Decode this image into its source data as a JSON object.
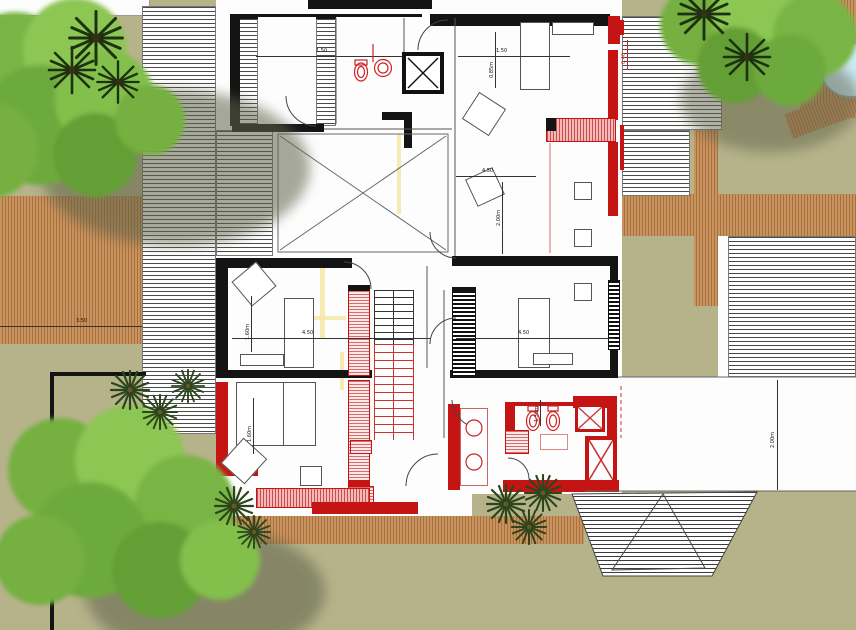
{
  "plan": {
    "type": "architectural-floor-plan-upper-level",
    "colors": {
      "lawn": "#b6b38a",
      "wood_deck": "#c9935f",
      "wood_stripe": "#a9713d",
      "roof_hatch_line": "#4a4a4a",
      "wall_black": "#141414",
      "wall_red": "#c41414",
      "pink_hatch": "#d96a6a",
      "pool_water": "#cdeaf6",
      "tree_green": "#7ab648",
      "palm_green": "#2c451c",
      "underlay_yellow": "#f4e8a6",
      "dimension_line": "#333333"
    },
    "symbols": {
      "tree": "canopy-blob",
      "palm": "frond-burst",
      "pool": "water-ellipse",
      "void_room": "x-cross-square",
      "elevator": "x-box-red",
      "shower": "x-box-red-small",
      "shaft": "x-box-black",
      "stairs_existing": "black-tread-lines",
      "stairs_new": "red-tread-lines"
    },
    "dimensions": [
      {
        "id": "deck-left-width",
        "label": "3.50"
      },
      {
        "id": "room-a-width",
        "label": "4.50"
      },
      {
        "id": "room-mid-right-width",
        "label": "4.50"
      },
      {
        "id": "room-lower-right-width",
        "label": "4.50"
      },
      {
        "id": "corridor-height",
        "label": "2.00m"
      },
      {
        "id": "room-a-depth",
        "label": "1.60m"
      },
      {
        "id": "room-b-depth",
        "label": "1.60m"
      },
      {
        "id": "right-setback",
        "label": "2.00m"
      },
      {
        "id": "bath-top-width",
        "label": "0.85m"
      },
      {
        "id": "top-rooms-span",
        "label": "1.50"
      },
      {
        "id": "top-right-span",
        "label": "1.50"
      },
      {
        "id": "balcony-offset",
        "label": "0.40"
      },
      {
        "id": "bath-depth",
        "label": "1.30m"
      }
    ]
  }
}
